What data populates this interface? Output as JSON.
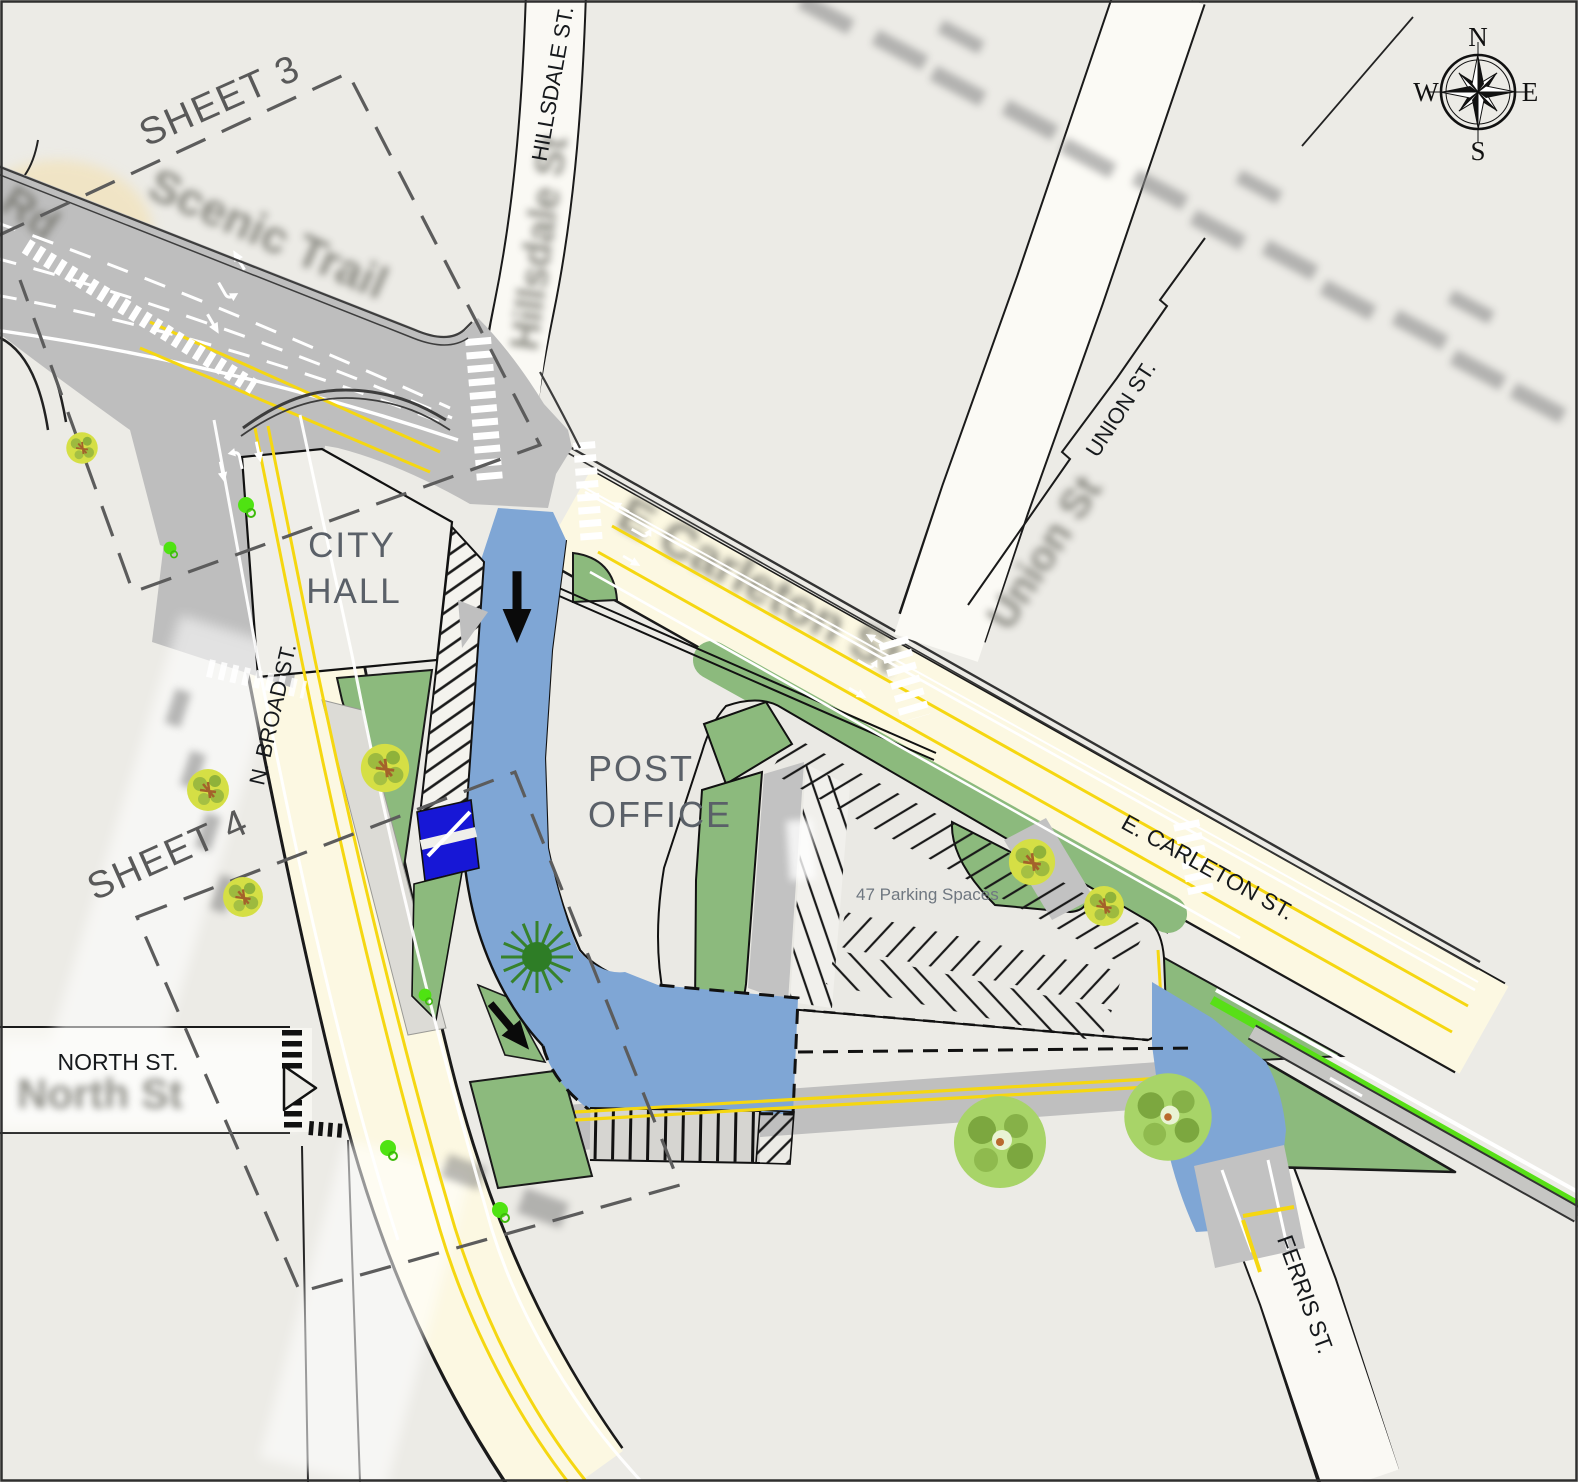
{
  "sheets": {
    "sheet3": "SHEET 3",
    "sheet4": "SHEET 4"
  },
  "places": {
    "city_hall": [
      "CITY",
      "HALL"
    ],
    "post_office": [
      "POST",
      "OFFICE"
    ]
  },
  "streets": {
    "hillsdale": "HILLSDALE ST.",
    "union": "UNION ST.",
    "carleton": "E. CARLETON ST.",
    "broad": "N. BROAD ST.",
    "north": "NORTH ST.",
    "ferris": "FERRIS ST."
  },
  "notes": {
    "parking": "47 Parking Spaces"
  },
  "compass": {
    "n": "N",
    "e": "E",
    "s": "S",
    "w": "W"
  },
  "underlay_text": {
    "trail": "Scenic Trail",
    "road": "Rd",
    "hillsdale": "Hillsdale St",
    "union": "Union St",
    "carleton": "E Carleton St",
    "north": "North St"
  },
  "colors": {
    "background": "#ECEBE6",
    "proposed_pavement_gray": "#BEBEBE",
    "existing_road_cream": "#FCF8E2",
    "proposed_street_blue": "#7FA6D5",
    "handicap_stall_blue": "#1717D6",
    "landscape_green": "#8CBA7D",
    "bike_lane_green": "#58DF17",
    "centerline_yellow": "#F5D711"
  }
}
